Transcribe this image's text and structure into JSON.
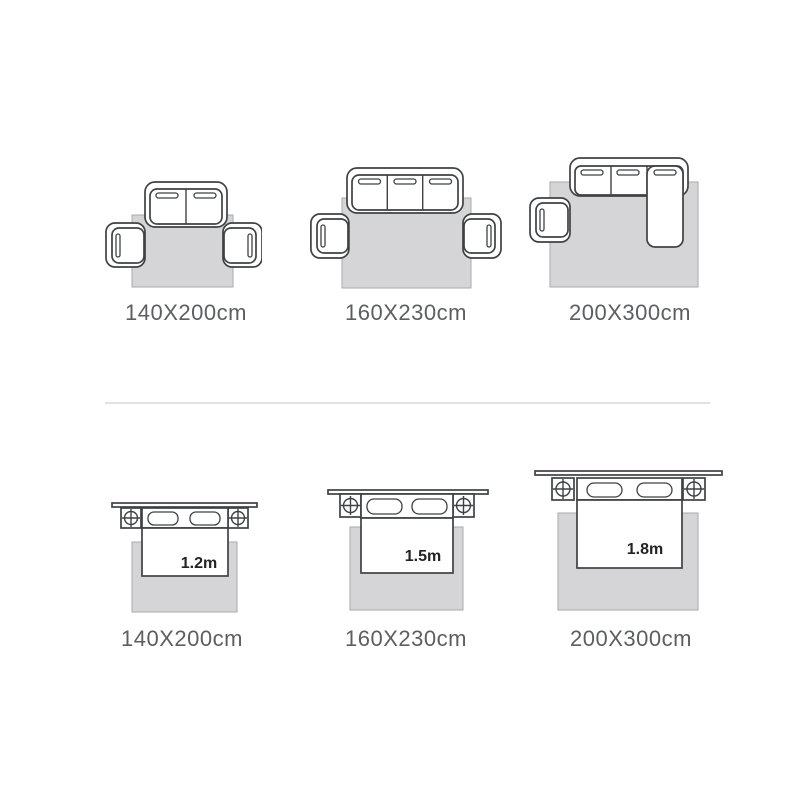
{
  "colors": {
    "background": "#ffffff",
    "furniture_outline": "#3f4145",
    "rug_fill": "#d5d5d7",
    "rug_outline": "#aaaaac",
    "size_label_text": "#5d5e60",
    "bed_width_text": "#232325",
    "divider": "#e2e2e4"
  },
  "sofa_row": {
    "items": [
      {
        "icon": "loveseat-sofa-two-armchairs-on-rug-icon",
        "label": "140X200cm"
      },
      {
        "icon": "three-seat-sofa-two-armchairs-on-rug-icon",
        "label": "160X230cm"
      },
      {
        "icon": "sectional-sofa-armchair-on-rug-icon",
        "label": "200X300cm"
      }
    ]
  },
  "bed_row": {
    "items": [
      {
        "icon": "double-bed-nightstands-on-rug-icon",
        "bed_width": "1.2m",
        "label": "140X200cm"
      },
      {
        "icon": "double-bed-nightstands-on-rug-icon",
        "bed_width": "1.5m",
        "label": "160X230cm"
      },
      {
        "icon": "double-bed-nightstands-on-rug-icon",
        "bed_width": "1.8m",
        "label": "200X300cm"
      }
    ]
  }
}
